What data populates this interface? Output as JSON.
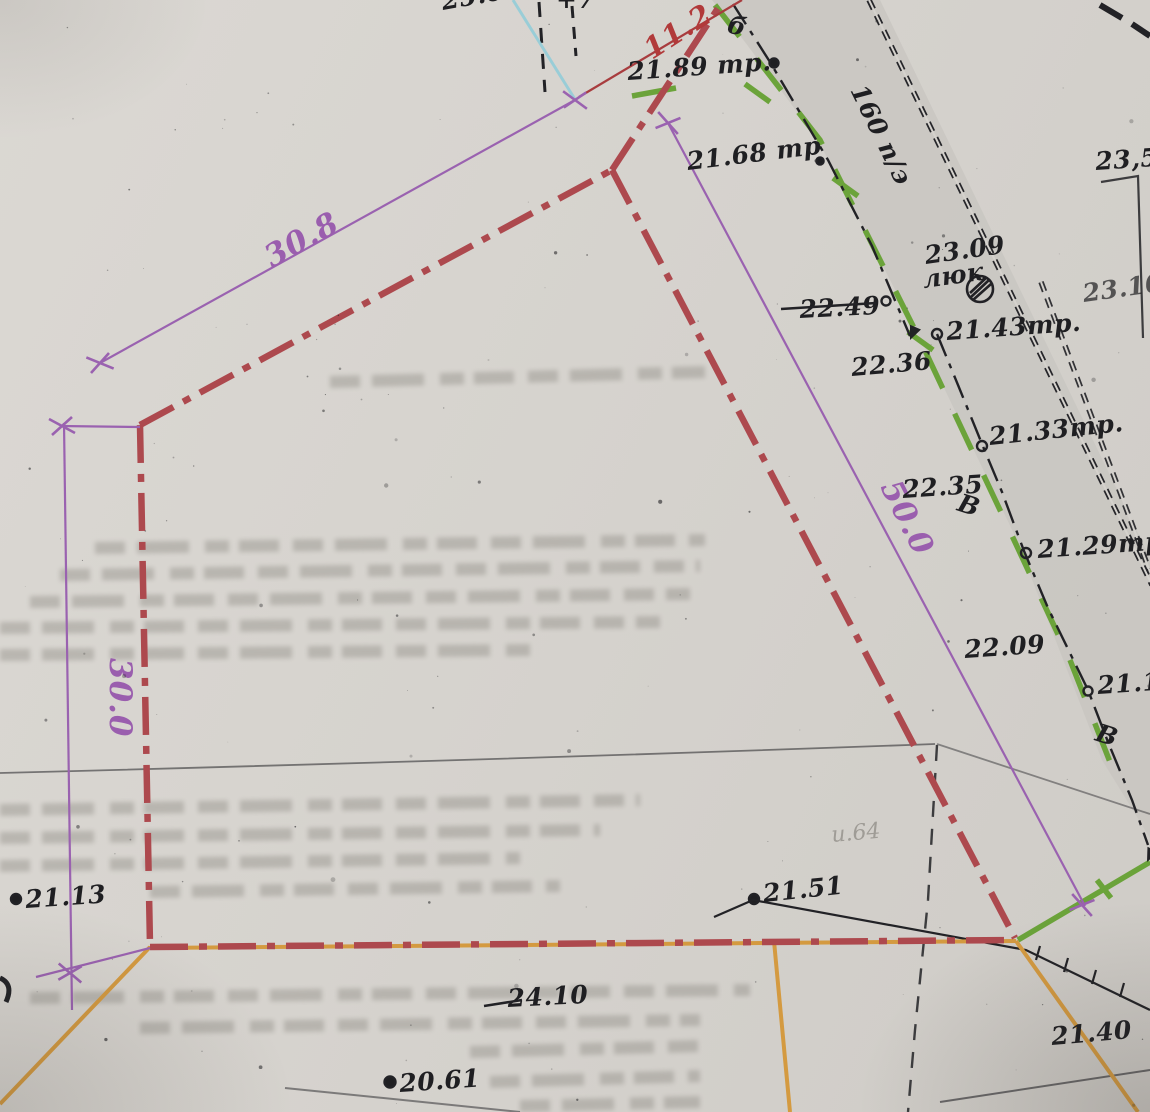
{
  "labels": {
    "dim_top_side": "30.8",
    "dim_left_side": "30.0",
    "dim_right_side": "50.0",
    "dim_top_stub": "11.2",
    "elev_tr_1": "21.89 тр.",
    "elev_tr_2": "21.68 тр",
    "manhole_elev": "23.09",
    "manhole_word": "люк",
    "elev_22_49": "22.49",
    "elev_22_36": "22.36",
    "elev_tr_3": "21.43тр.",
    "elev_tr_4": "21.33тр.",
    "elev_22_35": "22.35",
    "elev_tr_5": "21.29тр",
    "elev_22_09": "22.09",
    "elev_edge_right": "21.1",
    "elev_21_13": "21.13",
    "elev_21_51": "21.51",
    "elev_24_10": "24.10",
    "elev_20_61": "20.61",
    "elev_21_40": "21.40",
    "elev_23_5": "23,5",
    "elev_23_10": "23.10",
    "elev_top_partial": "25.05",
    "top_partial_mark": "+7",
    "pipe_size_label": "160 п/э",
    "valve_letter_1": "В",
    "valve_letter_2": "В",
    "pole_letter": "б",
    "ghost_note": "и.64"
  },
  "colors": {
    "paper": "#d6d3ce",
    "boundary_red": "#ad494e",
    "dimension_purple": "#9a5eae",
    "gas_green": "#6ba33a",
    "cadastre_orange": "#d49a40",
    "ink_black": "#1f1f22",
    "road_grey": "#c8c5c0",
    "stub_dimension_red": "#b13a3a",
    "utility_cyan": "#8ecbd8"
  }
}
